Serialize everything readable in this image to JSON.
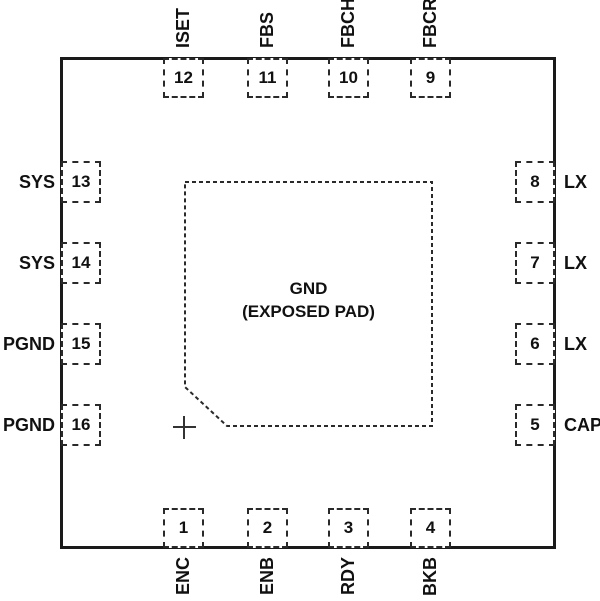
{
  "diagram": {
    "type": "ic-pinout-top-view",
    "colors": {
      "line": "#1a1a1a",
      "dash": "#2a2a2a",
      "background": "#ffffff",
      "text": "#111111"
    },
    "exposed_pad": {
      "line1": "GND",
      "line2": "(EXPOSED PAD)",
      "pin1_marker_icon": "crosshair-plus"
    },
    "pins": {
      "top": [
        {
          "num": "12",
          "name": "ISET"
        },
        {
          "num": "11",
          "name": "FBS"
        },
        {
          "num": "10",
          "name": "FBCH"
        },
        {
          "num": "9",
          "name": "FBCR"
        }
      ],
      "right": [
        {
          "num": "8",
          "name": "LX"
        },
        {
          "num": "7",
          "name": "LX"
        },
        {
          "num": "6",
          "name": "LX"
        },
        {
          "num": "5",
          "name": "CAP"
        }
      ],
      "bottom": [
        {
          "num": "1",
          "name": "ENC"
        },
        {
          "num": "2",
          "name": "ENB"
        },
        {
          "num": "3",
          "name": "RDY"
        },
        {
          "num": "4",
          "name": "BKB"
        }
      ],
      "left": [
        {
          "num": "13",
          "name": "SYS"
        },
        {
          "num": "14",
          "name": "SYS"
        },
        {
          "num": "15",
          "name": "PGND"
        },
        {
          "num": "16",
          "name": "PGND"
        }
      ]
    }
  }
}
